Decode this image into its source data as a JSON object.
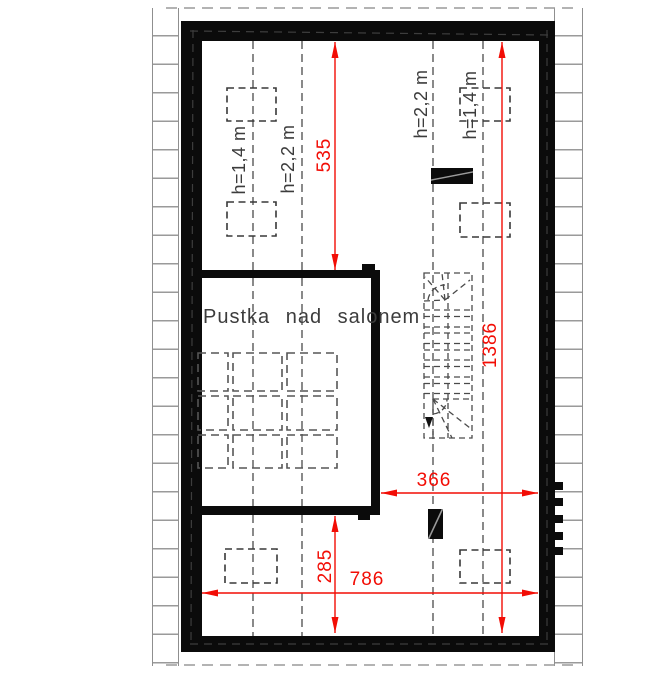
{
  "drawing_type": "attic floor plan",
  "room_label": "Pustka nad salonem",
  "height_labels": {
    "low": "h=1,4 m",
    "high": "h=2,2 m"
  },
  "dimensions": {
    "upper_segment": "535",
    "total_length": "1386",
    "stair_opening_width": "366",
    "total_width": "786",
    "lower_segment": "285"
  },
  "colors": {
    "dimension_red": "#f20d05",
    "wall_black": "#0b0b0b",
    "guide_gray": "#4a4a4a",
    "hatch_gray": "#9a9a9a",
    "label_gray": "#3c3c3c"
  }
}
